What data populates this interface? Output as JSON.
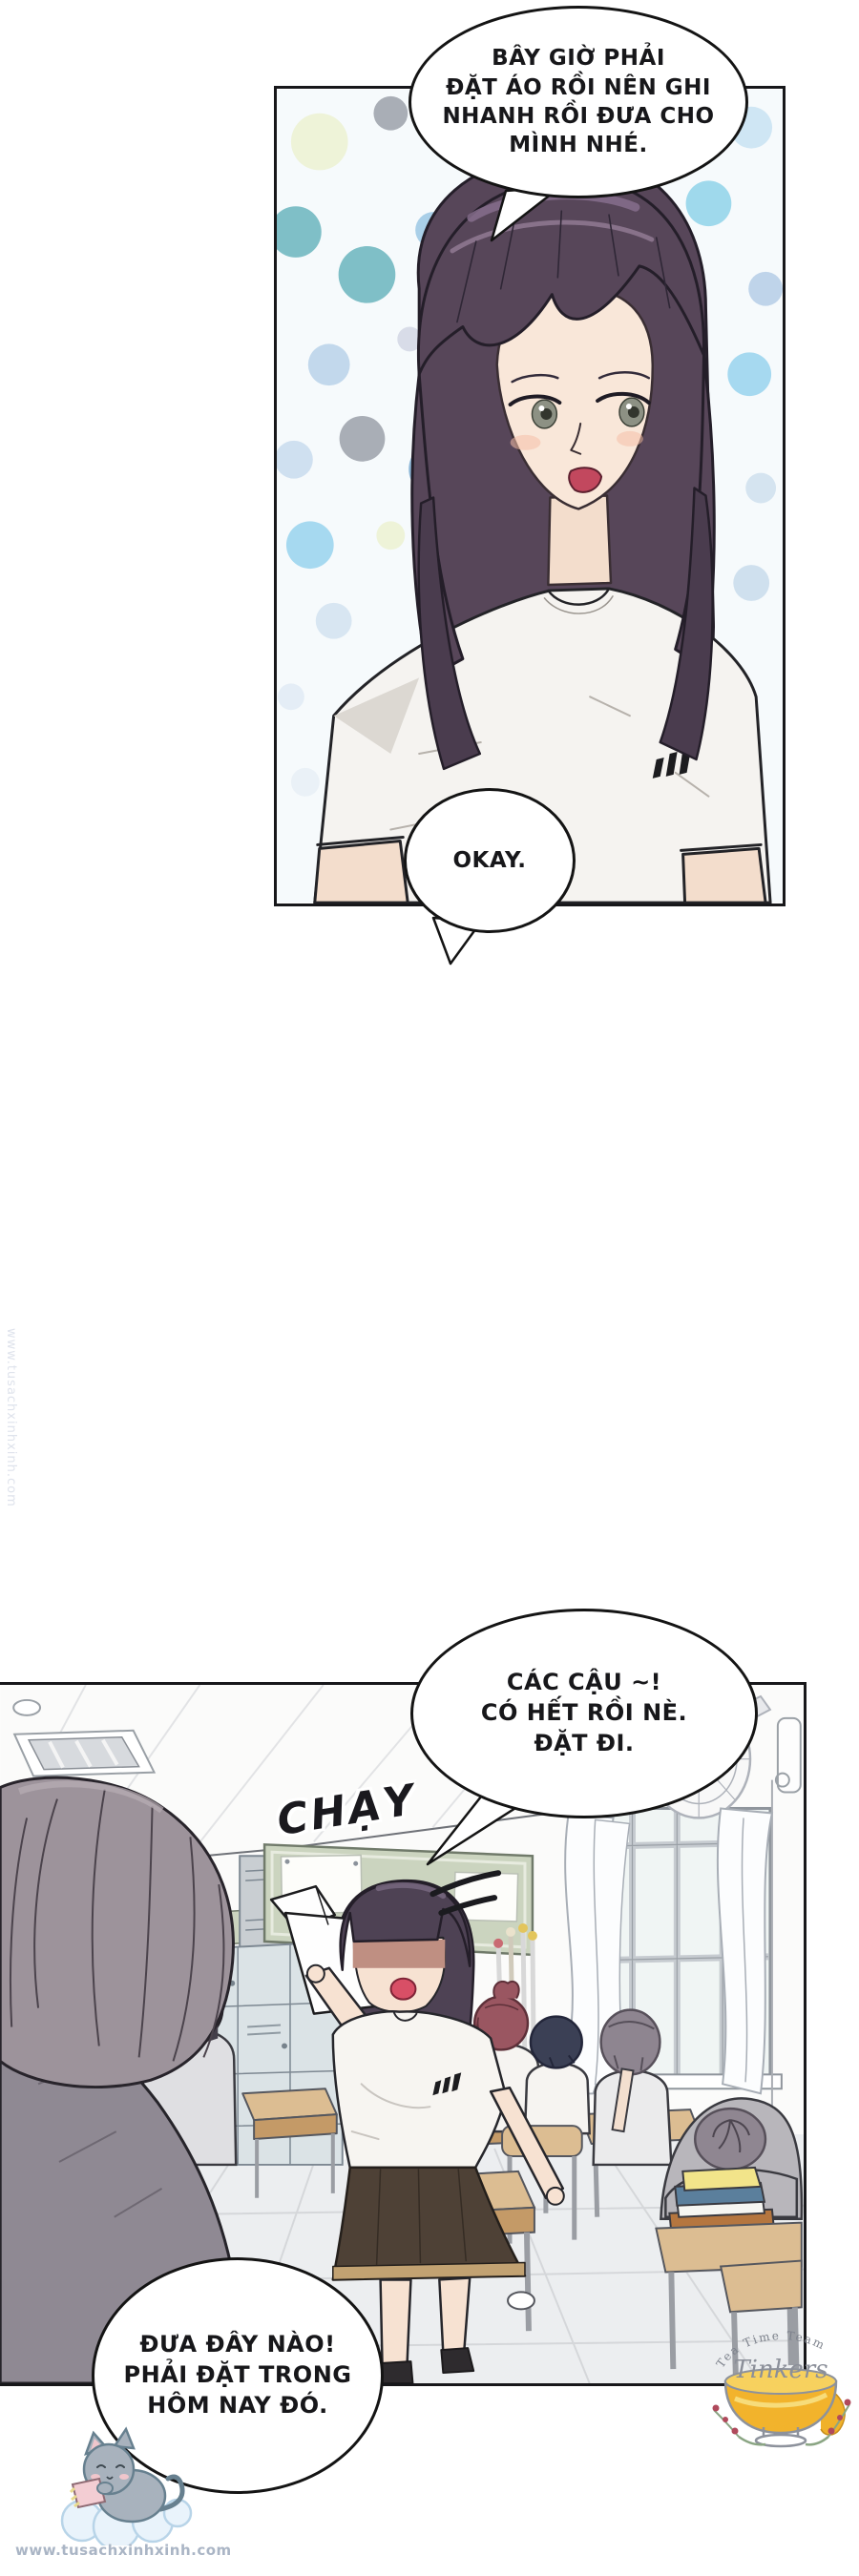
{
  "bubbles": {
    "bubble1": "BÂY GIỜ PHẢI\nĐẶT ÁO RỒI NÊN GHI\nNHANH RỒI ĐƯA CHO\nMÌNH NHÉ.",
    "bubble2": "OKAY.",
    "bubble3": "CÁC CẬU ~!\nCÓ HẾT RỒI NÈ.\nĐẶT ĐI.",
    "bubble4": "ĐƯA ĐÂY NÀO!\nPHẢI ĐẶT TRONG\nHÔM NAY ĐÓ."
  },
  "sfx": {
    "run": "CHẠY"
  },
  "watermark": {
    "site_bottom": "www.tusachxinhxinh.com",
    "site_side": "www.tusachxinhxinh.com"
  },
  "stamp": {
    "arc_text": "Tea Time Team",
    "script_text": "Tinkers"
  },
  "colors": {
    "panel_border": "#17171a",
    "hair_purple": "#574659",
    "hair_highlight": "#8a7190",
    "skin": "#f9e7d9",
    "mouth_red": "#c2485e",
    "shirt_white": "#f5f3f0",
    "skirt_brown": "#4e4136",
    "skirt_hem": "#c2a272",
    "locker_blue": "#dbe3e6",
    "board_green": "#cbd4bf",
    "desk_tan": "#dcbd92",
    "tea_gold": "#f2b32c",
    "dot_teal": "#7fbfc7",
    "dot_blue": "#8fb8d8"
  }
}
